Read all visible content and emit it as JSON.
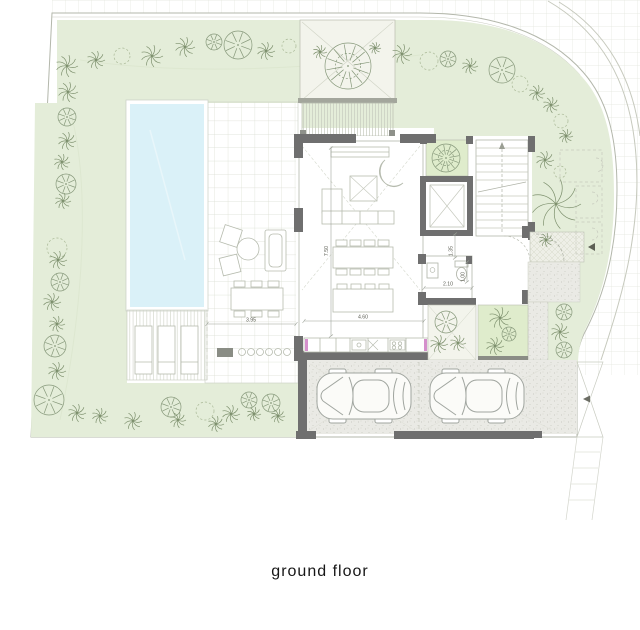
{
  "title": "ground floor",
  "dims": {
    "living_depth": "7.50",
    "kitchen_width": "4.60",
    "terrace_width": "3.95",
    "bath_width": "2.10",
    "wc_width": "1.00",
    "hall_width": "1.35"
  },
  "cars": [
    {
      "x": 313,
      "y": 369
    },
    {
      "x": 426,
      "y": 369
    }
  ],
  "trees": [
    [
      67,
      66,
      11,
      "p"
    ],
    [
      96,
      60,
      9,
      "p"
    ],
    [
      122,
      56,
      8,
      "d"
    ],
    [
      152,
      56,
      11,
      "p"
    ],
    [
      185,
      47,
      10,
      "p"
    ],
    [
      214,
      42,
      8,
      "r"
    ],
    [
      238,
      45,
      14,
      "r"
    ],
    [
      266,
      51,
      9,
      "p"
    ],
    [
      289,
      46,
      7,
      "d"
    ],
    [
      402,
      54,
      10,
      "p"
    ],
    [
      429,
      61,
      9,
      "d"
    ],
    [
      448,
      59,
      8,
      "r"
    ],
    [
      470,
      66,
      8,
      "p"
    ],
    [
      502,
      70,
      13,
      "r"
    ],
    [
      520,
      84,
      8,
      "d"
    ],
    [
      537,
      93,
      8,
      "p"
    ],
    [
      551,
      105,
      8,
      "p"
    ],
    [
      561,
      121,
      7,
      "d"
    ],
    [
      566,
      136,
      7,
      "p"
    ],
    [
      545,
      160,
      9,
      "p"
    ],
    [
      560,
      172,
      6,
      "d"
    ],
    [
      556,
      204,
      25,
      "p"
    ],
    [
      546,
      240,
      7,
      "p"
    ],
    [
      68,
      92,
      10,
      "p"
    ],
    [
      67,
      117,
      9,
      "r"
    ],
    [
      67,
      141,
      9,
      "p"
    ],
    [
      62,
      162,
      8,
      "p"
    ],
    [
      66,
      184,
      10,
      "r"
    ],
    [
      63,
      201,
      8,
      "p"
    ],
    [
      57,
      248,
      10,
      "d"
    ],
    [
      58,
      260,
      9,
      "p"
    ],
    [
      60,
      282,
      9,
      "r"
    ],
    [
      52,
      302,
      9,
      "p"
    ],
    [
      57,
      324,
      8,
      "p"
    ],
    [
      55,
      346,
      11,
      "r"
    ],
    [
      57,
      371,
      9,
      "p"
    ],
    [
      49,
      400,
      15,
      "r"
    ],
    [
      77,
      413,
      9,
      "p"
    ],
    [
      100,
      416,
      8,
      "p"
    ],
    [
      133,
      421,
      9,
      "p"
    ],
    [
      171,
      407,
      10,
      "r"
    ],
    [
      178,
      420,
      8,
      "p"
    ],
    [
      205,
      411,
      9,
      "d"
    ],
    [
      216,
      424,
      8,
      "p"
    ],
    [
      231,
      414,
      9,
      "p"
    ],
    [
      249,
      400,
      8,
      "r"
    ],
    [
      254,
      414,
      7,
      "p"
    ],
    [
      271,
      403,
      9,
      "r"
    ],
    [
      278,
      416,
      7,
      "p"
    ],
    [
      564,
      312,
      8,
      "r"
    ],
    [
      560,
      332,
      9,
      "p"
    ],
    [
      564,
      350,
      8,
      "r"
    ],
    [
      446,
      158,
      14,
      "s"
    ],
    [
      446,
      322,
      11,
      "r"
    ],
    [
      439,
      344,
      9,
      "p"
    ],
    [
      458,
      343,
      8,
      "p"
    ],
    [
      500,
      318,
      11,
      "p"
    ],
    [
      509,
      334,
      7,
      "r"
    ],
    [
      495,
      346,
      9,
      "p"
    ],
    [
      348,
      66,
      23,
      "s"
    ],
    [
      320,
      52,
      7,
      "p"
    ],
    [
      375,
      48,
      6,
      "p"
    ]
  ],
  "colors": {
    "garden": "#e4edd9",
    "planter_green": "#dfeccc",
    "pool": "#daf1f8",
    "wall_dark": "#6f6f6f",
    "accent_magenta": "#d590cc",
    "tree_stroke": "#86987a"
  }
}
